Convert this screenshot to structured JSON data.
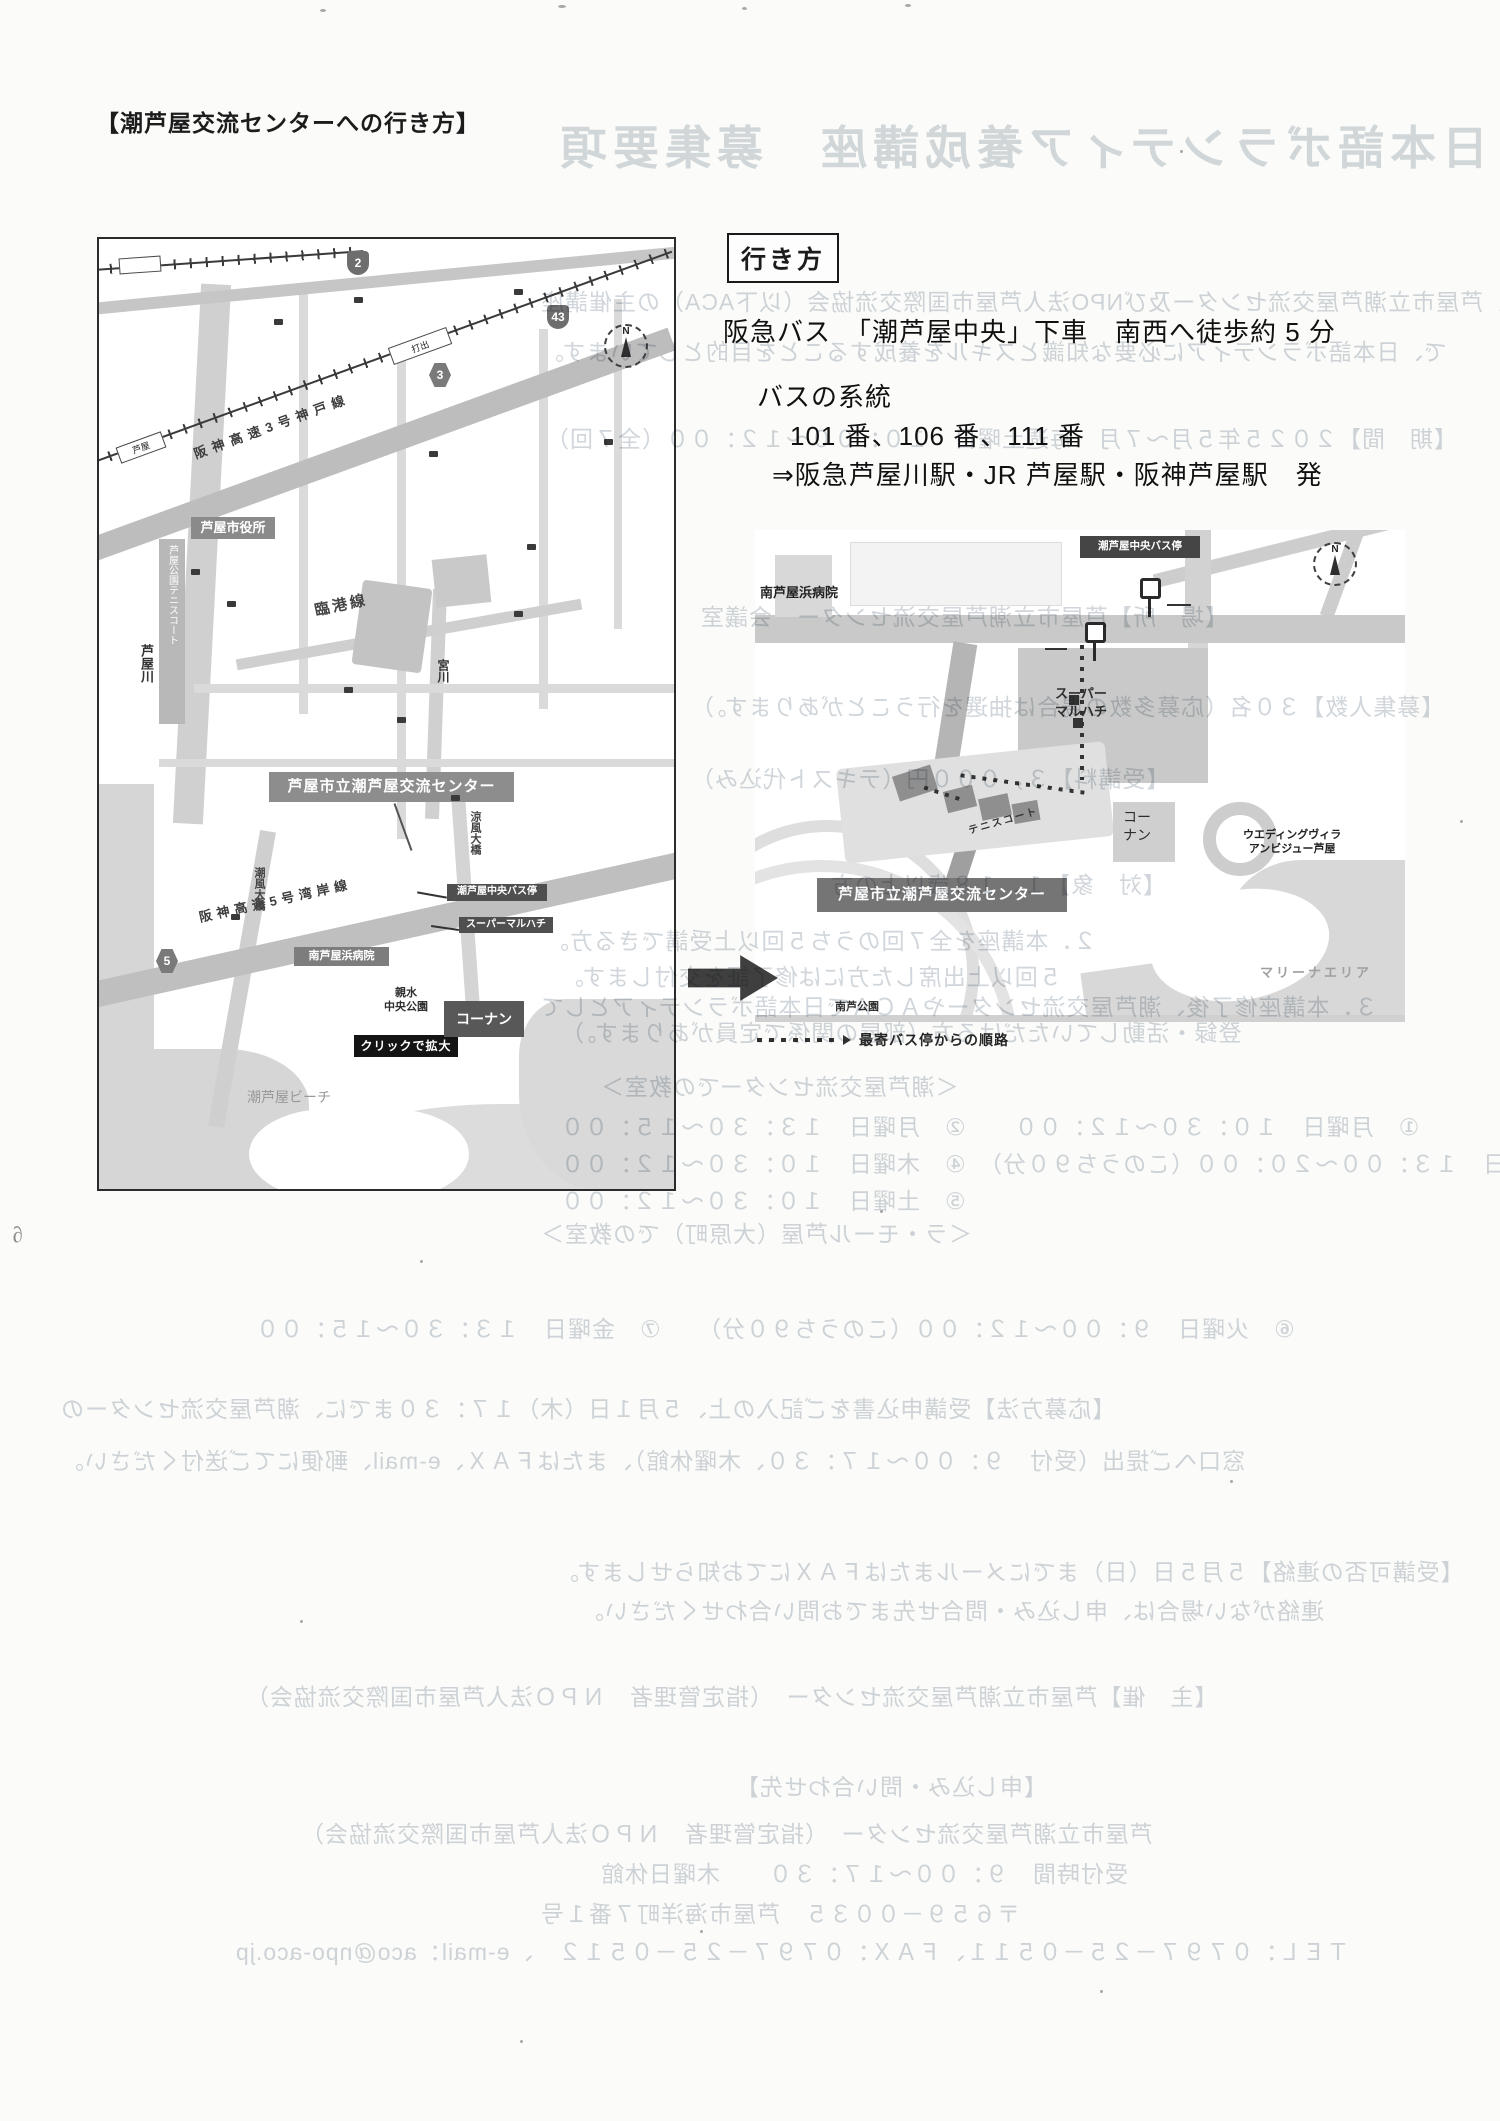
{
  "page": {
    "header": "【潮芦屋交流センターへの行き方】",
    "scribble": "∂"
  },
  "directions": {
    "box_label": "行き方",
    "line1": "阪急バス　「潮芦屋中央」下車　南西へ徒歩約 5 分",
    "line2": "バスの系統",
    "line3": "101 番、106 番、111 番",
    "line4": "⇒阪急芦屋川駅・JR 芦屋駅・阪神芦屋駅　発"
  },
  "map_left": {
    "city_hall": "芦屋市役所",
    "center_label": "芦屋市立潮芦屋交流センター",
    "bus_stop": "潮芦屋中央バス停",
    "supermarket": "スーパーマルハチ",
    "hospital": "南芦屋浜病院",
    "park_water_1": "親水",
    "park_water_2": "中央公園",
    "click_enlarge": "クリックで拡大",
    "kohnan": "コーナン",
    "beach": "潮芦屋ビーチ",
    "river_ashiyagawa": "芦屋川",
    "tennis_court": "芦屋公園テニスコート",
    "rinko_line": "臨港線",
    "miyagawa": "宮川",
    "shiokaze_bridge": "潮風大橋",
    "suzukaze_bridge": "涼風大橋",
    "wangan_expwy": "阪神高速5号湾岸線",
    "kobe_expwy": "阪神高速3号神戸線",
    "station_ashiya": "芦屋",
    "station_uchide": "打出",
    "shield_2": "2",
    "shield_43": "43",
    "shield_3": "3",
    "shield_5": "5",
    "compass_n": "N"
  },
  "map_right": {
    "bus_stop_label": "潮芦屋中央バス停",
    "hospital": "南芦屋浜病院",
    "supermarket_1": "スーパー",
    "supermarket_2": "マルハチ",
    "tennis": "テニスコート",
    "center_label": "芦屋市立潮芦屋交流センター",
    "kohnan_1": "コー",
    "kohnan_2": "ナン",
    "wedding_1": "ウエディングヴィラ",
    "wedding_2": "アンビジュー芦屋",
    "marina": "マリーナエリア",
    "park": "南芦公園",
    "legend_text": "最寄バス停からの順路",
    "compass_n": "N"
  },
  "bleedthrough": {
    "title": "日本語ボランティア養成講座　募集要項",
    "lines": [
      "この講座は、芦屋市立潮芦屋交流センター及びNPO法人芦屋市国際交流協会（以下ACA）の主催講座",
      "で、日本語ボランティアに必要な知識とスキルを養成することを目的としています。",
      "【期　間】２０２５年５月～７月　毎週土曜日　１０：００～１２：００（全７回）",
      "【場　所】芦屋市立潮芦屋交流センター　会議室",
      "【募集人数】３０名（応募多数の場合は抽選を行うことがあります。）",
      "【受講料】３，０００円（テキスト代込み）",
      "【対　象】１．１８歳以上の方",
      "２．本講座を全７回のうち５回以上受講できる方。",
      "５回以上出席した方には修了証を交付します。",
      "３．本講座修了後、潮芦屋交流センターやＡＣＡで日本語ボランティアとして",
      "登録・活動していただける方（部屋の関係で定員があります。）",
      "＜潮芦屋交流センターでの教室＞",
      "①　月曜日　１０：３０～１２：００　　②　月曜日　１３：３０～１５：００",
      "③　火曜日　１３：００～２０：００（このうち９０分）　④　木曜日　１０：３０～１２：００",
      "⑤　土曜日　１０：３０～１２：００",
      "＜ラ・モール芦屋（大原町）での教室＞",
      "⑥　火曜日　９：００～１２：００（このうち９０分）　　⑦　金曜日　１３：３０～１５：００",
      "【応募方法】受講申込書をご記入の上、５月１日（木）１７：３０までに、潮芦屋交流センターの",
      "窓口へご提出（受付　９：００～１７：３０、木曜休館）、またはＦＡＸ、e-mail、郵便にてご送付ください。",
      "【受講可否の連絡】５月５日（日）までにメールまたはＦＡＸにてお知らせします。",
      "連絡がない場合は、申し込み・問合せ先までお問い合わせください。",
      "【主　催】芦屋市立潮芦屋交流センター　（指定管理者　ＮＰＯ法人芦屋市国際交流協会）",
      "【申し込み・問い合わせ先】",
      "芦屋市立潮芦屋交流センター　（指定管理者　ＮＰＯ法人芦屋市国際交流協会）",
      "受付時間　９：００～１７：３０　　木曜日休館",
      "〒６５９－００３５　芦屋市海洋町７番１号",
      "ＴＥＬ：０７９７－２５－０５１１、ＦＡＸ：０７９７－２５－０５１２　、e-mail：aco@npo-aco.jp"
    ]
  }
}
